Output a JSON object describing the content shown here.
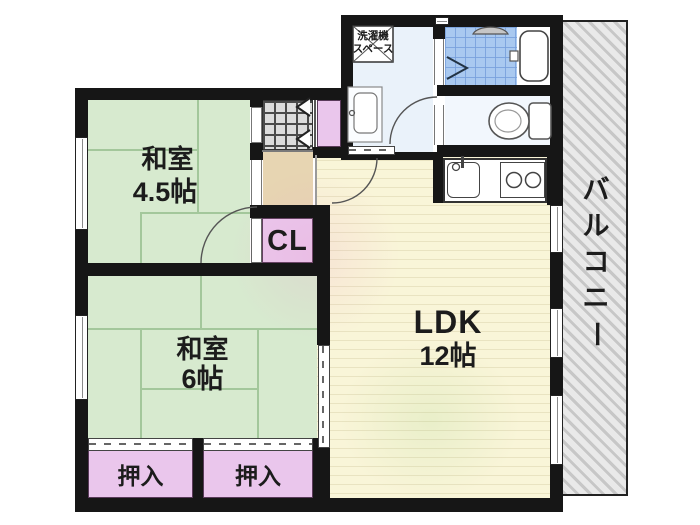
{
  "plan": {
    "type": "apartment-floor-plan",
    "rooms": {
      "washitsu45": {
        "name": "和室",
        "size": "4.5帖"
      },
      "washitsu6": {
        "name": "和室",
        "size": "6帖"
      },
      "ldk": {
        "name": "LDK",
        "size": "12帖"
      },
      "closet_cl": {
        "label": "CL"
      },
      "oshiire": [
        {
          "label": "押入"
        },
        {
          "label": "押入"
        }
      ],
      "laundry": {
        "line1": "洗濯機",
        "line2": "スペース"
      },
      "balcony": {
        "label": "バルコニー",
        "chars": [
          "バ",
          "ル",
          "コ",
          "ニ",
          "ー"
        ]
      }
    },
    "fixtures": [
      "bathtub",
      "toilet",
      "washbasin",
      "kitchen-sink",
      "gas-stove",
      "shower-head",
      "washing-machine-space",
      "swing-door",
      "folding-door",
      "sliding-door",
      "window"
    ],
    "colors": {
      "wall": "#161616",
      "tatami": "#d7eacf",
      "ldk_floor": "#f9f5d8",
      "closet_purple": "#eac6ec",
      "hall_beige": "#e7d5b2",
      "bath_tile_blue": "#a9c9f0",
      "washroom_floor": "#eaf2fa",
      "entrance_tile_gray": "#dcdcdc",
      "balcony_hatch_gray": "#c7c7c7"
    }
  }
}
